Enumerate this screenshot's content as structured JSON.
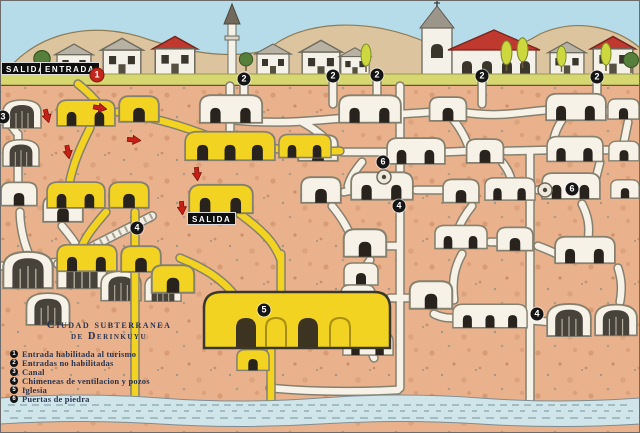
{
  "scene_title": "Ciudad subterranea de Derinkuyu",
  "labels": {
    "exit_top": "SALIDA",
    "entrance_top": "ENTRADA",
    "exit_mid": "SALIDA"
  },
  "legend": {
    "title_line1": "Ciudad subterranea",
    "title_line2": "de Derinkuyu",
    "items": [
      {
        "num": "1",
        "text": "Entrada habilitada al turismo"
      },
      {
        "num": "2",
        "text": "Entradas no habilitadas"
      },
      {
        "num": "3",
        "text": "Canal"
      },
      {
        "num": "4",
        "text": "Chimeneas de ventilacion y pozos"
      },
      {
        "num": "5",
        "text": "Iglesia"
      },
      {
        "num": "6",
        "text": "Puertas de piedra"
      }
    ]
  },
  "markers": [
    {
      "num": "1",
      "x": 97,
      "y": 75,
      "variant": "red"
    },
    {
      "num": "2",
      "x": 244,
      "y": 79,
      "variant": "black"
    },
    {
      "num": "2",
      "x": 333,
      "y": 76,
      "variant": "black"
    },
    {
      "num": "2",
      "x": 377,
      "y": 75,
      "variant": "black"
    },
    {
      "num": "2",
      "x": 482,
      "y": 76,
      "variant": "black"
    },
    {
      "num": "2",
      "x": 597,
      "y": 77,
      "variant": "black"
    },
    {
      "num": "3",
      "x": 3,
      "y": 117,
      "variant": "black"
    },
    {
      "num": "4",
      "x": 137,
      "y": 228,
      "variant": "black"
    },
    {
      "num": "4",
      "x": 399,
      "y": 206,
      "variant": "black"
    },
    {
      "num": "4",
      "x": 537,
      "y": 314,
      "variant": "black"
    },
    {
      "num": "5",
      "x": 264,
      "y": 310,
      "variant": "black"
    },
    {
      "num": "6",
      "x": 383,
      "y": 162,
      "variant": "black"
    },
    {
      "num": "6",
      "x": 572,
      "y": 189,
      "variant": "black"
    }
  ],
  "colors": {
    "sky": "#b5dce8",
    "hills": "#dbc49e",
    "earth": "#e9b28c",
    "grass": "#d6d76f",
    "tourist_route_yellow": "#f2d321",
    "tunnel_white": "#f6f2e8",
    "water": "#cfe5ea",
    "marker_black": "#151515",
    "marker_red": "#c3271c",
    "roof_red": "#c0392f",
    "legend_text": "#2b3551"
  }
}
